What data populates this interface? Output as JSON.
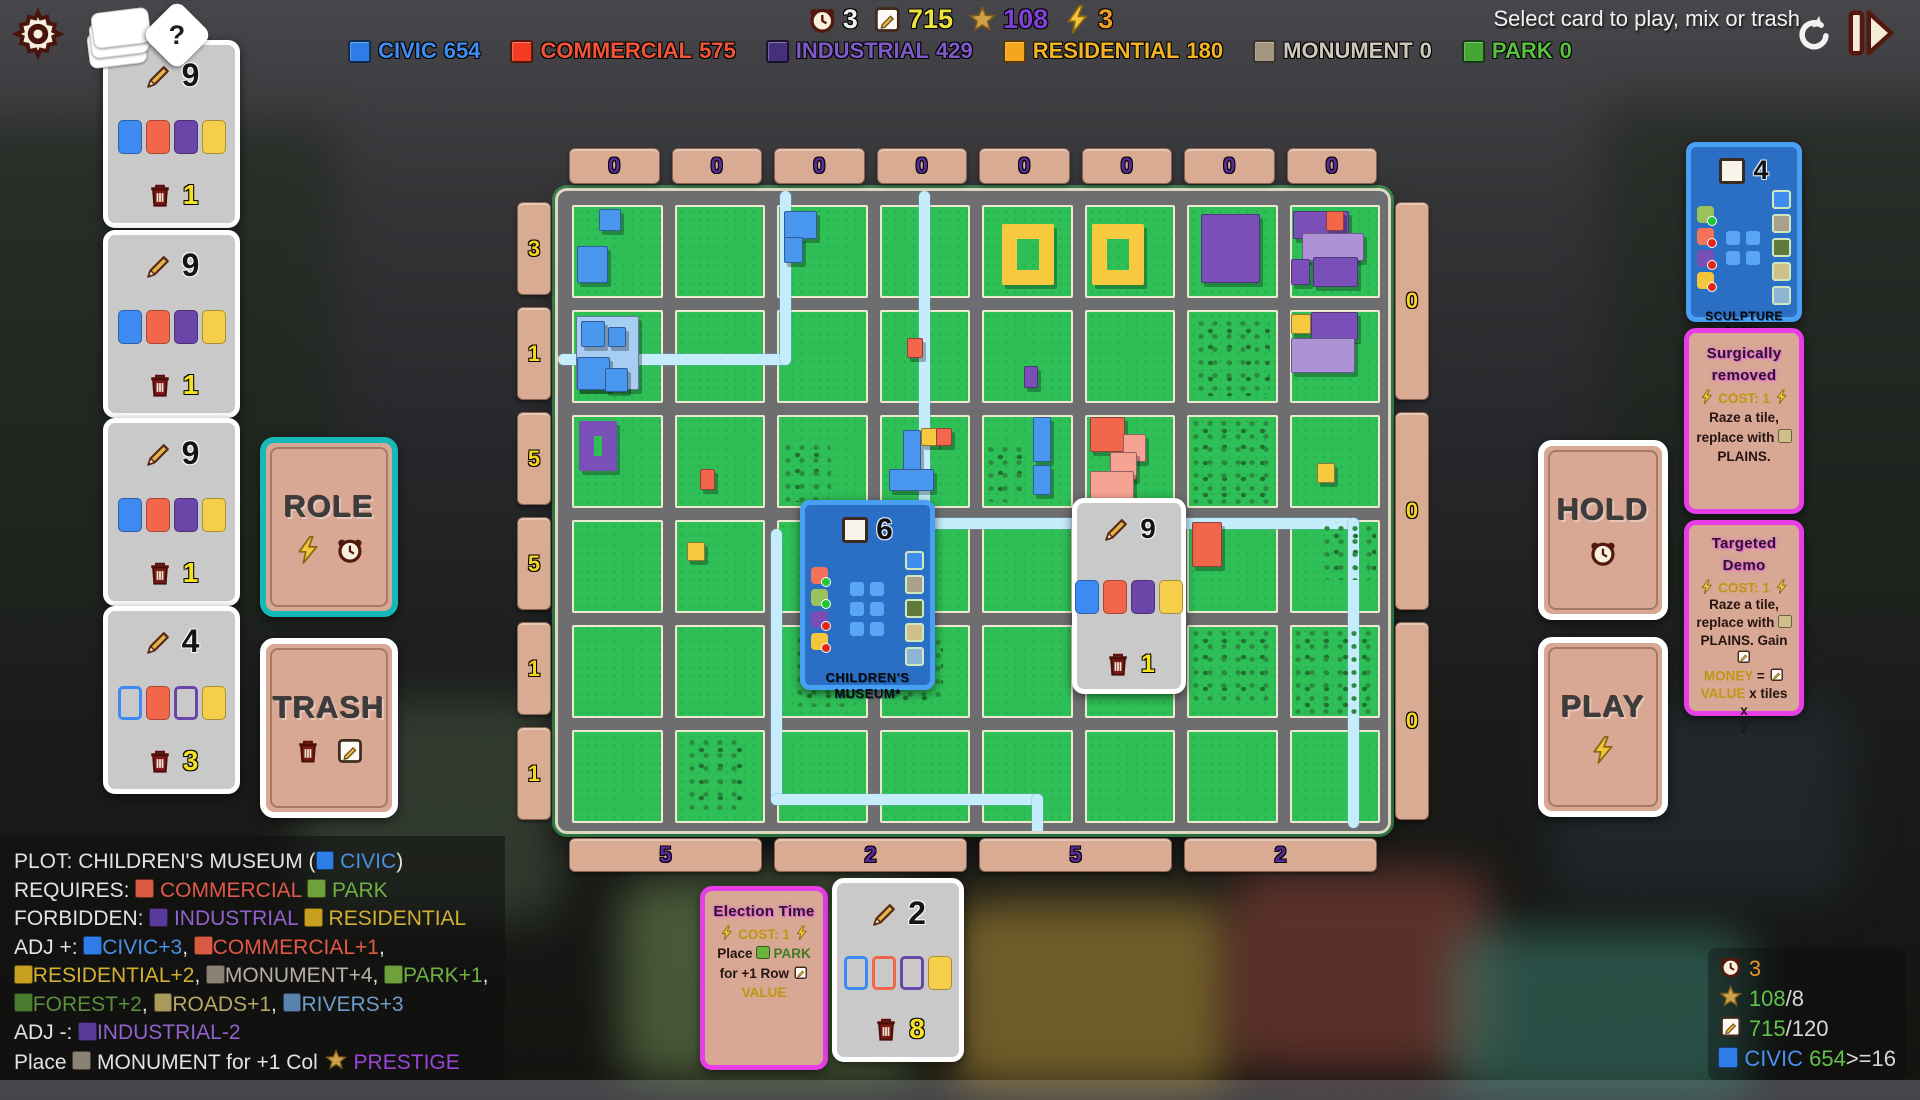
{
  "header": {
    "message": "Select card to play, mix or trash",
    "resources": [
      {
        "icon": "clock",
        "value": "3",
        "color": "#f2f2f2"
      },
      {
        "icon": "note",
        "value": "715",
        "color": "#f0e23c"
      },
      {
        "icon": "star",
        "value": "108",
        "color": "#8040d8"
      },
      {
        "icon": "bolt",
        "value": "3",
        "color": "#f09c28"
      }
    ],
    "legend": [
      {
        "label": "CIVIC",
        "value": "654",
        "sq": "#2d7ce8",
        "tc": "#3f8df2"
      },
      {
        "label": "COMMERCIAL",
        "value": "575",
        "sq": "#f23c22",
        "tc": "#f25438"
      },
      {
        "label": "INDUSTRIAL",
        "value": "429",
        "sq": "#46307e",
        "tc": "#8059c8"
      },
      {
        "label": "RESIDENTIAL",
        "value": "180",
        "sq": "#f5a61c",
        "tc": "#f5b422"
      },
      {
        "label": "MONUMENT",
        "value": "0",
        "sq": "#a3957f",
        "tc": "#cfc8ba"
      },
      {
        "label": "PARK",
        "value": "0",
        "sq": "#45a636",
        "tc": "#57c23f"
      }
    ]
  },
  "hand": {
    "cards": [
      {
        "cost": "9",
        "trash": "1",
        "tiles": [
          {
            "c": "#3d8bf2",
            "f": 1
          },
          {
            "c": "#f2664a",
            "f": 1
          },
          {
            "c": "#6a46a8",
            "f": 1
          },
          {
            "c": "#f5ce4a",
            "f": 1
          }
        ]
      },
      {
        "cost": "9",
        "trash": "1",
        "tiles": [
          {
            "c": "#3d8bf2",
            "f": 1
          },
          {
            "c": "#f2664a",
            "f": 1
          },
          {
            "c": "#6a46a8",
            "f": 1
          },
          {
            "c": "#f5ce4a",
            "f": 1
          }
        ]
      },
      {
        "cost": "9",
        "trash": "1",
        "tiles": [
          {
            "c": "#3d8bf2",
            "f": 1
          },
          {
            "c": "#f2664a",
            "f": 1
          },
          {
            "c": "#6a46a8",
            "f": 1
          },
          {
            "c": "#f5ce4a",
            "f": 1
          }
        ]
      },
      {
        "cost": "4",
        "trash": "3",
        "tiles": [
          {
            "c": "#3d8bf2",
            "f": 0
          },
          {
            "c": "#f2664a",
            "f": 1
          },
          {
            "c": "#6a46a8",
            "f": 0
          },
          {
            "c": "#f5ce4a",
            "f": 1
          }
        ]
      }
    ]
  },
  "board_hand_card": {
    "cost": "9",
    "trash": "1",
    "tiles": [
      {
        "c": "#3d8bf2",
        "f": 1
      },
      {
        "c": "#f2664a",
        "f": 1
      },
      {
        "c": "#6a46a8",
        "f": 1
      },
      {
        "c": "#f5ce4a",
        "f": 1
      }
    ]
  },
  "deck_card": {
    "cost": "2",
    "trash": "8",
    "tiles": [
      {
        "c": "#3d8bf2",
        "f": 0
      },
      {
        "c": "#f2664a",
        "f": 0
      },
      {
        "c": "#6a46a8",
        "f": 0
      },
      {
        "c": "#f5ce4a",
        "f": 1
      }
    ]
  },
  "role_card": {
    "label": "ROLE"
  },
  "trash_card": {
    "label": "TRASH"
  },
  "hold_card": {
    "label": "HOLD"
  },
  "play_card": {
    "label": "PLAY"
  },
  "plot_card": {
    "value": "6",
    "name": "CHILDREN'S MUSEUM*",
    "req": [
      {
        "c": "#f2725a",
        "m": "ok"
      },
      {
        "c": "#9bc25a",
        "m": "ok"
      },
      {
        "c": "#7a4fb5",
        "m": "no"
      },
      {
        "c": "#f5c53c",
        "m": "no"
      }
    ],
    "grid": {
      "rows": 3,
      "cols": 2
    },
    "side": [
      "#3d8ef0",
      "#a9a18c",
      "#5d7a3a",
      "#cfc08a",
      "#8fb5d5"
    ]
  },
  "sculpture_card": {
    "value": "4",
    "name": "SCULPTURE PARK*",
    "req": [
      {
        "c": "#9bc25a",
        "m": "ok"
      },
      {
        "c": "#f2725a",
        "m": "no"
      },
      {
        "c": "#7a4fb5",
        "m": "no"
      },
      {
        "c": "#f5c53c",
        "m": "no"
      }
    ],
    "grid": {
      "rows": 2,
      "cols": 2
    },
    "side": [
      "#3d8ef0",
      "#a9a18c",
      "#5d7a3a",
      "#cfc08a",
      "#8fb5d5"
    ]
  },
  "action_cards": {
    "surgical": {
      "title": "Surgically removed",
      "body": [
        {
          "i": "bolt"
        },
        {
          "t": " COST: 1 ",
          "c": "#bf9612"
        },
        {
          "i": "bolt"
        },
        {
          "br": 1
        },
        {
          "t": "Raze a tile,"
        },
        {
          "br": 1
        },
        {
          "t": "replace with "
        },
        {
          "chip": "#cfc08a"
        },
        {
          "br": 1
        },
        {
          "t": "PLAINS."
        }
      ]
    },
    "targeted": {
      "title": "Targeted Demo",
      "body": [
        {
          "i": "bolt"
        },
        {
          "t": " COST: 1 ",
          "c": "#bf9612"
        },
        {
          "i": "bolt"
        },
        {
          "br": 1
        },
        {
          "t": "Raze a tile,"
        },
        {
          "br": 1
        },
        {
          "t": "replace with "
        },
        {
          "chip": "#cfc08a"
        },
        {
          "br": 1
        },
        {
          "t": "PLAINS. Gain "
        },
        {
          "i": "note"
        },
        {
          "br": 1
        },
        {
          "t": "MONEY",
          "c": "#bf9612"
        },
        {
          "t": " = "
        },
        {
          "i": "note"
        },
        {
          "br": 1
        },
        {
          "t": "VALUE",
          "c": "#bf9612"
        },
        {
          "t": " x tiles x"
        },
        {
          "br": 1
        },
        {
          "t": "2"
        }
      ]
    },
    "election": {
      "title": "Election Time",
      "body": [
        {
          "i": "bolt"
        },
        {
          "t": " COST: 1 ",
          "c": "#bf9612"
        },
        {
          "i": "bolt"
        },
        {
          "br": 1
        },
        {
          "t": "Place "
        },
        {
          "chip": "#6ab53a"
        },
        {
          "t": " PARK",
          "c": "#3f7a1f"
        },
        {
          "br": 1
        },
        {
          "t": "for +1 Row ",
          "c": "#241410"
        },
        {
          "i": "note"
        },
        {
          "br": 1
        },
        {
          "t": "VALUE",
          "c": "#bf9612"
        }
      ]
    }
  },
  "board": {
    "col_headers": [
      "0",
      "0",
      "0",
      "0",
      "0",
      "0",
      "0",
      "0"
    ],
    "row_labels": [
      "3",
      "1",
      "5",
      "5",
      "1",
      "1"
    ],
    "right_labels": [
      "0",
      "0",
      "0"
    ],
    "col_footers": [
      "5",
      "2",
      "5",
      "2"
    ]
  },
  "info_panel": {
    "lines": [
      [
        {
          "t": "PLOT: CHILDREN'S MUSEUM ("
        },
        {
          "chip": "#2d7ce8"
        },
        {
          "t": " CIVIC",
          "c": "#4a90e2"
        },
        {
          "t": ")"
        }
      ],
      [
        {
          "t": "REQUIRES: "
        },
        {
          "chip": "#d85a42"
        },
        {
          "t": " COMMERCIAL ",
          "c": "#e25848"
        },
        {
          "chip": "#6fa03c"
        },
        {
          "t": " PARK",
          "c": "#6fb043"
        }
      ],
      [
        {
          "t": "FORBIDDEN: "
        },
        {
          "chip": "#5a3a9a"
        },
        {
          "t": " INDUSTRIAL ",
          "c": "#9262cc"
        },
        {
          "chip": "#c8a020"
        },
        {
          "t": " RESIDENTIAL",
          "c": "#d4b030"
        }
      ],
      [
        {
          "t": "ADJ +: "
        },
        {
          "chip": "#2d7ce8"
        },
        {
          "t": "CIVIC+3",
          "c": "#4a90e2"
        },
        {
          "t": ", "
        },
        {
          "chip": "#d85a42"
        },
        {
          "t": "COMMERCIAL+1",
          "c": "#e25848"
        },
        {
          "t": ","
        }
      ],
      [
        {
          "chip": "#c8a020"
        },
        {
          "t": "RESIDENTIAL+2",
          "c": "#d4b030"
        },
        {
          "t": ", "
        },
        {
          "chip": "#8a8274"
        },
        {
          "t": "MONUMENT+4",
          "c": "#b8b0a0"
        },
        {
          "t": ", "
        },
        {
          "chip": "#6fa03c"
        },
        {
          "t": "PARK+1",
          "c": "#6fb043"
        },
        {
          "t": ","
        }
      ],
      [
        {
          "chip": "#4a7a2e"
        },
        {
          "t": "FOREST+2",
          "c": "#5a8f3f"
        },
        {
          "t": ", "
        },
        {
          "chip": "#a89a5a"
        },
        {
          "t": "ROADS+1",
          "c": "#b8a865"
        },
        {
          "t": ", "
        },
        {
          "chip": "#5a82b0"
        },
        {
          "t": "RIVERS+3",
          "c": "#6f9cc9"
        }
      ],
      [
        {
          "t": "ADJ -: "
        },
        {
          "chip": "#5a3a9a"
        },
        {
          "t": "INDUSTRIAL-2",
          "c": "#9262cc"
        }
      ],
      [
        {
          "t": "Place "
        },
        {
          "chip": "#8a8274"
        },
        {
          "t": " MONUMENT for +1 Col "
        },
        {
          "i": "star"
        },
        {
          "t": " PRESTIGE",
          "c": "#9a46d8"
        }
      ]
    ]
  },
  "stats": {
    "lines": [
      [
        {
          "i": "clock"
        },
        {
          "t": " 3",
          "c": "#e8922e"
        }
      ],
      [
        {
          "i": "star"
        },
        {
          "t": " 108",
          "c": "#62c24a"
        },
        {
          "t": "/8",
          "c": "#d8d8d8"
        }
      ],
      [
        {
          "i": "note"
        },
        {
          "t": " 715",
          "c": "#62c24a"
        },
        {
          "t": "/120",
          "c": "#d8d8d8"
        }
      ],
      [
        {
          "chip": "#2d7ce8"
        },
        {
          "t": " CIVIC ",
          "c": "#4a8ff0"
        },
        {
          "t": "654",
          "c": "#62c24a"
        },
        {
          "t": ">=16",
          "c": "#d8d8d8"
        }
      ]
    ]
  },
  "map": {
    "tiles": [
      {
        "r": 0,
        "c": 0,
        "x": 30,
        "y": 4,
        "w": 22,
        "h": 22,
        "k": "B"
      },
      {
        "r": 0,
        "c": 0,
        "x": 6,
        "y": 44,
        "w": 32,
        "h": 38,
        "k": "B"
      },
      {
        "r": 0,
        "c": 2,
        "x": 8,
        "y": 6,
        "w": 34,
        "h": 28,
        "k": "B"
      },
      {
        "r": 0,
        "c": 2,
        "x": 8,
        "y": 34,
        "w": 18,
        "h": 26,
        "k": "B"
      },
      {
        "r": 0,
        "c": 4,
        "x": 22,
        "y": 20,
        "w": 58,
        "h": 66,
        "k": "Y",
        "d": 1
      },
      {
        "r": 0,
        "c": 5,
        "x": 8,
        "y": 20,
        "w": 58,
        "h": 66,
        "k": "Y",
        "d": 1
      },
      {
        "r": 0,
        "c": 6,
        "x": 16,
        "y": 10,
        "w": 62,
        "h": 72,
        "k": "U"
      },
      {
        "r": 0,
        "c": 7,
        "x": 4,
        "y": 6,
        "w": 60,
        "h": 28,
        "k": "U"
      },
      {
        "r": 0,
        "c": 7,
        "x": 40,
        "y": 6,
        "w": 18,
        "h": 20,
        "k": "R"
      },
      {
        "r": 0,
        "c": 7,
        "x": 14,
        "y": 30,
        "w": 66,
        "h": 28,
        "k": "LU"
      },
      {
        "r": 0,
        "c": 7,
        "x": 26,
        "y": 56,
        "w": 48,
        "h": 30,
        "k": "U"
      },
      {
        "r": 0,
        "c": 7,
        "x": 2,
        "y": 58,
        "w": 18,
        "h": 26,
        "k": "U"
      },
      {
        "r": 1,
        "c": 0,
        "x": 4,
        "y": 6,
        "w": 68,
        "h": 78,
        "k": "LB"
      },
      {
        "r": 1,
        "c": 0,
        "x": 10,
        "y": 12,
        "w": 24,
        "h": 26,
        "k": "B"
      },
      {
        "r": 1,
        "c": 0,
        "x": 40,
        "y": 18,
        "w": 18,
        "h": 20,
        "k": "B"
      },
      {
        "r": 1,
        "c": 0,
        "x": 6,
        "y": 50,
        "w": 34,
        "h": 34,
        "k": "B"
      },
      {
        "r": 1,
        "c": 0,
        "x": 36,
        "y": 62,
        "w": 24,
        "h": 24,
        "k": "B"
      },
      {
        "r": 1,
        "c": 3,
        "x": 30,
        "y": 30,
        "w": 16,
        "h": 20,
        "k": "R"
      },
      {
        "r": 1,
        "c": 4,
        "x": 46,
        "y": 60,
        "w": 14,
        "h": 22,
        "k": "U"
      },
      {
        "r": 1,
        "c": 7,
        "x": 2,
        "y": 4,
        "w": 20,
        "h": 20,
        "k": "Y"
      },
      {
        "r": 1,
        "c": 7,
        "x": 24,
        "y": 2,
        "w": 50,
        "h": 28,
        "k": "U"
      },
      {
        "r": 1,
        "c": 7,
        "x": 2,
        "y": 30,
        "w": 68,
        "h": 36,
        "k": "LU"
      },
      {
        "r": 2,
        "c": 0,
        "x": 8,
        "y": 6,
        "w": 42,
        "h": 54,
        "k": "U",
        "d": 1
      },
      {
        "r": 2,
        "c": 1,
        "x": 28,
        "y": 58,
        "w": 15,
        "h": 20,
        "k": "R"
      },
      {
        "r": 2,
        "c": 3,
        "x": 26,
        "y": 16,
        "w": 18,
        "h": 46,
        "k": "B"
      },
      {
        "r": 2,
        "c": 3,
        "x": 10,
        "y": 58,
        "w": 48,
        "h": 22,
        "k": "B"
      },
      {
        "r": 2,
        "c": 3,
        "x": 46,
        "y": 14,
        "w": 16,
        "h": 17,
        "k": "Y"
      },
      {
        "r": 2,
        "c": 3,
        "x": 62,
        "y": 14,
        "w": 16,
        "h": 17,
        "k": "R"
      },
      {
        "r": 2,
        "c": 4,
        "x": 56,
        "y": 2,
        "w": 18,
        "h": 46,
        "k": "B"
      },
      {
        "r": 2,
        "c": 4,
        "x": 56,
        "y": 54,
        "w": 18,
        "h": 30,
        "k": "B"
      },
      {
        "r": 2,
        "c": 5,
        "x": 6,
        "y": 2,
        "w": 36,
        "h": 36,
        "k": "R"
      },
      {
        "r": 2,
        "c": 5,
        "x": 42,
        "y": 20,
        "w": 24,
        "h": 28,
        "k": "P"
      },
      {
        "r": 2,
        "c": 5,
        "x": 28,
        "y": 40,
        "w": 28,
        "h": 28,
        "k": "P"
      },
      {
        "r": 2,
        "c": 5,
        "x": 6,
        "y": 60,
        "w": 46,
        "h": 28,
        "k": "P"
      },
      {
        "r": 2,
        "c": 7,
        "x": 30,
        "y": 52,
        "w": 18,
        "h": 19,
        "k": "Y"
      },
      {
        "r": 3,
        "c": 1,
        "x": 14,
        "y": 24,
        "w": 17,
        "h": 18,
        "k": "Y"
      },
      {
        "r": 3,
        "c": 2,
        "x": 60,
        "y": 0,
        "w": 32,
        "h": 58,
        "k": "U"
      },
      {
        "r": 3,
        "c": 2,
        "x": 36,
        "y": 30,
        "w": 56,
        "h": 32,
        "k": "LU"
      },
      {
        "r": 3,
        "c": 3,
        "x": 0,
        "y": 0,
        "w": 30,
        "h": 32,
        "k": "LU"
      },
      {
        "r": 3,
        "c": 6,
        "x": 6,
        "y": 2,
        "w": 30,
        "h": 46,
        "k": "R"
      }
    ],
    "forests": [
      {
        "r": 1,
        "c": 6,
        "x": 8,
        "y": 8,
        "w": 84,
        "h": 84
      },
      {
        "r": 2,
        "c": 2,
        "x": 4,
        "y": 28,
        "w": 56,
        "h": 66
      },
      {
        "r": 2,
        "c": 4,
        "x": 2,
        "y": 30,
        "w": 42,
        "h": 64
      },
      {
        "r": 2,
        "c": 6,
        "x": 2,
        "y": 2,
        "w": 94,
        "h": 94
      },
      {
        "r": 3,
        "c": 7,
        "x": 34,
        "y": 2,
        "w": 62,
        "h": 62
      },
      {
        "r": 4,
        "c": 2,
        "x": 18,
        "y": 10,
        "w": 72,
        "h": 78
      },
      {
        "r": 4,
        "c": 3,
        "x": 10,
        "y": 12,
        "w": 60,
        "h": 70
      },
      {
        "r": 4,
        "c": 6,
        "x": 2,
        "y": 2,
        "w": 94,
        "h": 80
      },
      {
        "r": 4,
        "c": 7,
        "x": 2,
        "y": 2,
        "w": 94,
        "h": 94
      },
      {
        "r": 5,
        "c": 1,
        "x": 12,
        "y": 6,
        "w": 64,
        "h": 80
      }
    ],
    "rivers": [
      {
        "x": 0,
        "y": 163,
        "w": 232,
        "h": 11
      },
      {
        "x": 222,
        "y": 0,
        "w": 11,
        "h": 174
      },
      {
        "x": 361,
        "y": 0,
        "w": 11,
        "h": 338
      },
      {
        "x": 361,
        "y": 327,
        "w": 440,
        "h": 11
      },
      {
        "x": 790,
        "y": 327,
        "w": 11,
        "h": 310
      },
      {
        "x": 213,
        "y": 338,
        "w": 11,
        "h": 276
      },
      {
        "x": 213,
        "y": 603,
        "w": 272,
        "h": 11
      },
      {
        "x": 474,
        "y": 603,
        "w": 11,
        "h": 43
      }
    ]
  }
}
